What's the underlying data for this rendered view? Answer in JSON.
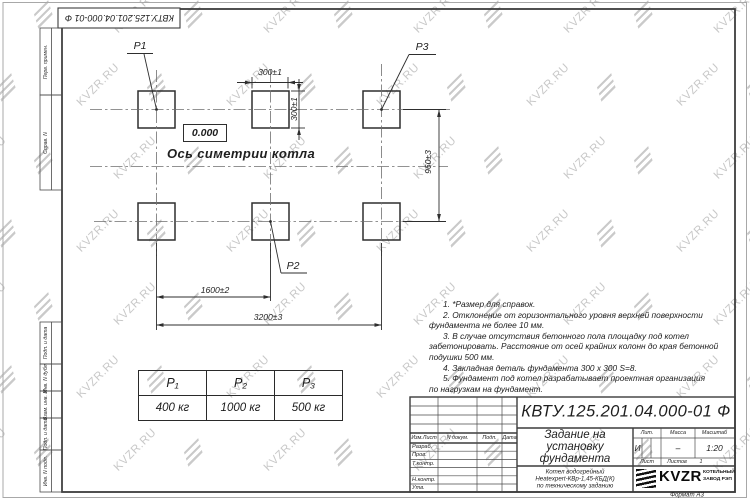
{
  "watermark": {
    "text": "KVZR.RU"
  },
  "corner_stamp": {
    "text": "КВТУ.125.201.04.000-01  Ф"
  },
  "sidebar": {
    "labels": [
      "Перв. примен.",
      "Справ. N",
      "Подп. и дата",
      "Инв. N дубл.",
      "Взам. инв. N",
      "Подп. и дата",
      "Инв. N подл."
    ]
  },
  "drawing": {
    "elevation": "0.000",
    "axis_label": "Ось симетрии котла",
    "point_labels": {
      "p1": "Р1",
      "p2": "Р2",
      "p3": "Р3"
    },
    "dimensions": {
      "pad_width": "300±1",
      "pad_height": "300±1",
      "row_spacing": "960±3",
      "mid_span": "1600±2",
      "full_span": "3200±3"
    }
  },
  "load_table": {
    "headers": [
      "Р₁",
      "Р₂",
      "Р₃"
    ],
    "values": [
      "400 кг",
      "1000 кг",
      "500 кг"
    ]
  },
  "notes": {
    "lines": [
      "1. *Размер для справок.",
      "2. Отклонение от горизонтального уровня верхней поверхности",
      "фундамента не более 10 мм.",
      "3. В случае отсутствия бетонного пола площадку под котел",
      "забетонировать. Расстояние от осей крайних колонн до края бетонной",
      "подушки 500 мм.",
      "4. Закладная деталь фундамента 300 х 300 S=8.",
      "5. Фундамент под котел разрабатывает проектная организация",
      "по нагрузкам на фундамент."
    ]
  },
  "title_block": {
    "doc_number": "КВТУ.125.201.04.000-01 Ф",
    "title_lines": [
      "Задание на",
      "установку",
      "фундамента"
    ],
    "product_lines": [
      "Котел водогрейный",
      "Heatexpert-КВр-1,45-КБД(К)",
      "по техническому заданию"
    ],
    "header_cells": [
      "Изм.Лист",
      "N докум.",
      "Подп.",
      "Дата"
    ],
    "row_labels": [
      "Разраб.",
      "Пров.",
      "Т.контр.",
      "Н.контр.",
      "Утв."
    ],
    "lit_label": "Лит.",
    "mass_label": "Масса",
    "scale_label": "Масштаб",
    "lit_value": "И",
    "mass_value": "–",
    "scale_value": "1:20",
    "sheet_label": "Лист",
    "sheets_label": "Листов",
    "sheets_value": "1",
    "logo_text": "KVZR",
    "company_lines": [
      "КОТЕЛЬНЫЙ",
      "ЗАВОД РЭП"
    ],
    "format_label": "Формат А3"
  }
}
